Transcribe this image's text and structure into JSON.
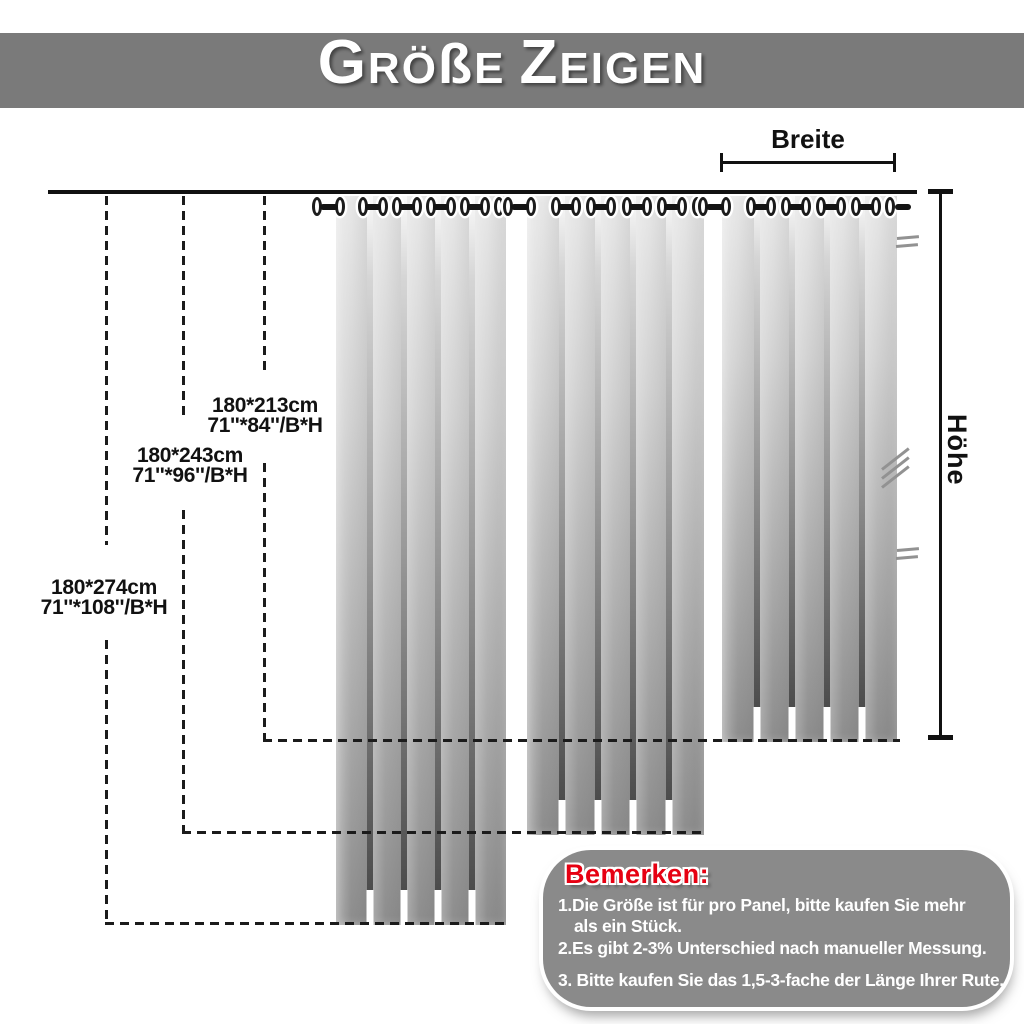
{
  "header": {
    "title_full": "Größe Zeigen",
    "seg_big1": "G",
    "seg_small1": "RÖ",
    "seg_sz": "ß",
    "seg_small2": "E",
    "seg_big2": "Z",
    "seg_small3": "EIGEN"
  },
  "measures": {
    "width_label": "Breite",
    "height_label": "Höhe"
  },
  "sizes": [
    {
      "cm": "180*213cm",
      "inches": "71''*84''/B*H"
    },
    {
      "cm": "180*243cm",
      "inches": "71''*96''/B*H"
    },
    {
      "cm": "180*274cm",
      "inches": "71''*108''/B*H"
    }
  ],
  "notes": {
    "title": "Bemerken:",
    "line1a": "1.Die Größe ist für pro Panel, bitte kaufen Sie mehr",
    "line1b": "als ein Stück.",
    "line2": "2.Es gibt 2-3% Unterschied nach manueller Messung.",
    "line3": "3. Bitte kaufen Sie das 1,5-3-fache der Länge Ihrer Rute."
  },
  "colors": {
    "header_bg": "#7a7a7a",
    "notes_bg": "#8a8a8a",
    "notes_title": "#e60012",
    "line_color": "#1b1b1b"
  }
}
